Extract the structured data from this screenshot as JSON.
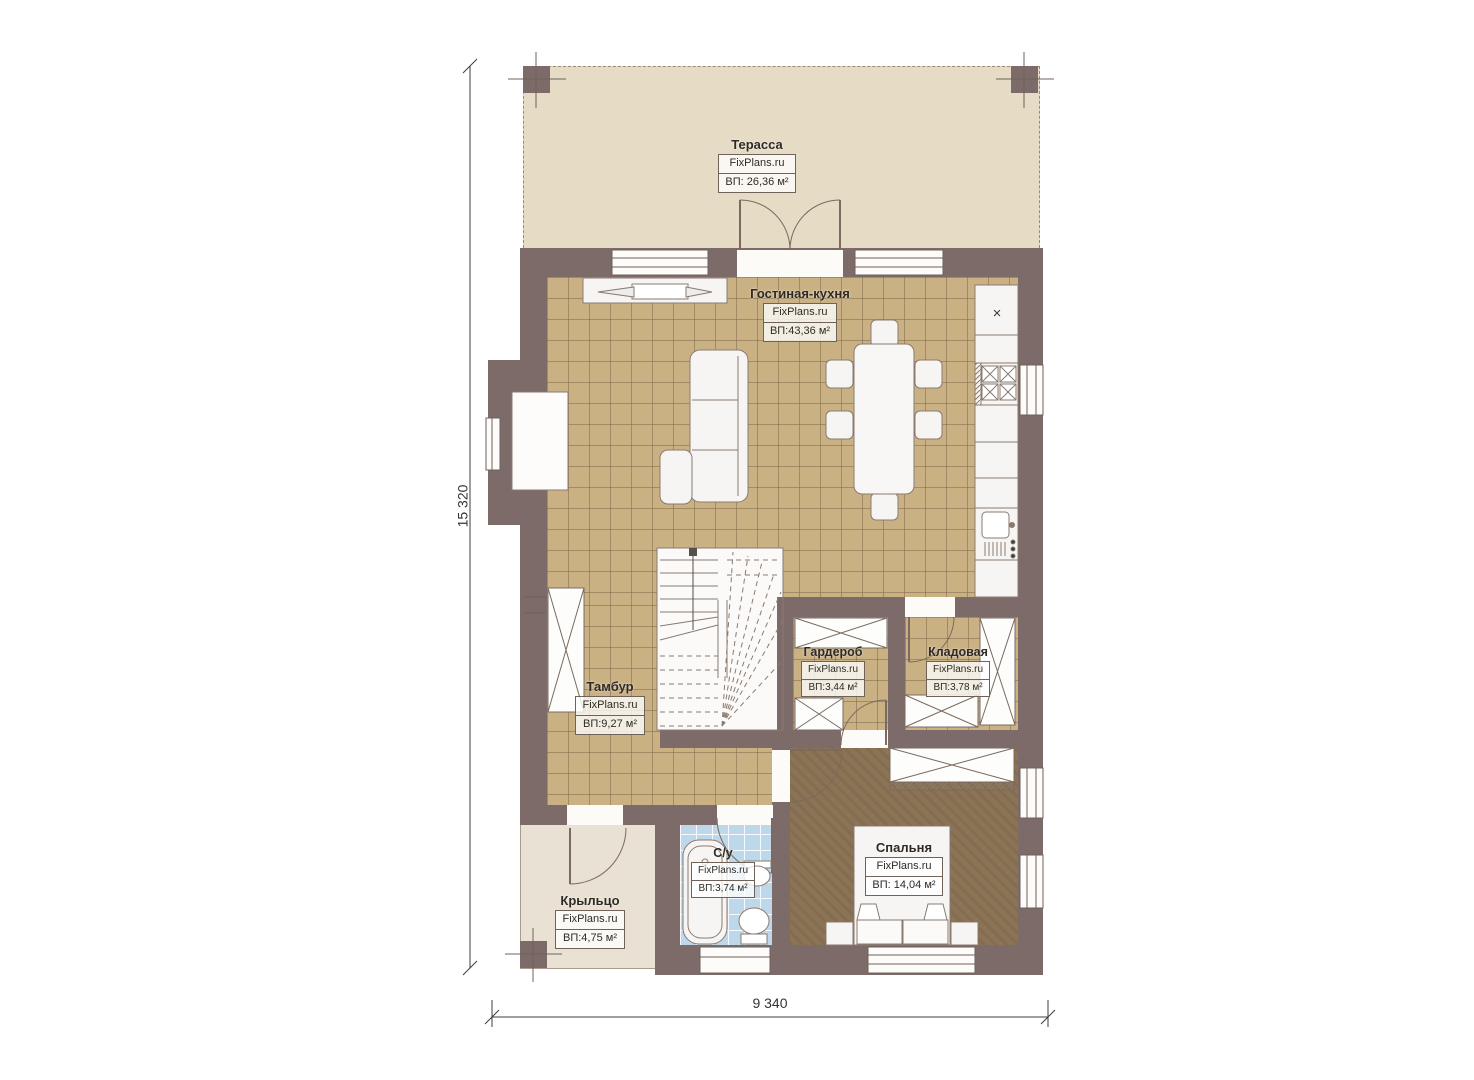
{
  "brand": "FixPlans.ru",
  "dimensions": {
    "vertical": "15 320",
    "horizontal": "9 340"
  },
  "rooms": [
    {
      "id": "terrace",
      "name": "Терасса",
      "area": "ВП: 26,36 м²"
    },
    {
      "id": "living-kitchen",
      "name": "Гостиная-кухня",
      "area": "ВП:43,36 м²"
    },
    {
      "id": "vestibule",
      "name": "Тамбур",
      "area": "ВП:9,27 м²"
    },
    {
      "id": "wardrobe",
      "name": "Гардероб",
      "area": "ВП:3,44 м²"
    },
    {
      "id": "storage",
      "name": "Кладовая",
      "area": "ВП:3,78 м²"
    },
    {
      "id": "bathroom",
      "name": "С/у",
      "area": "ВП:3,74 м²"
    },
    {
      "id": "bedroom",
      "name": "Спальня",
      "area": "ВП: 14,04 м²"
    },
    {
      "id": "porch",
      "name": "Крыльцо",
      "area": "ВП:4,75 м²"
    }
  ],
  "icons": {
    "fridge_mark": "×"
  },
  "colors": {
    "wall": "#7d6b6a",
    "tile_floor": "#c9b184",
    "terrace_floor": "#e6dbc5",
    "porch_floor": "#e9e1d3",
    "bedroom_floor": "#8b7355",
    "bathroom_tile": "#bcd8ea",
    "furniture": "#f6f5f3",
    "line": "#6f6258"
  }
}
